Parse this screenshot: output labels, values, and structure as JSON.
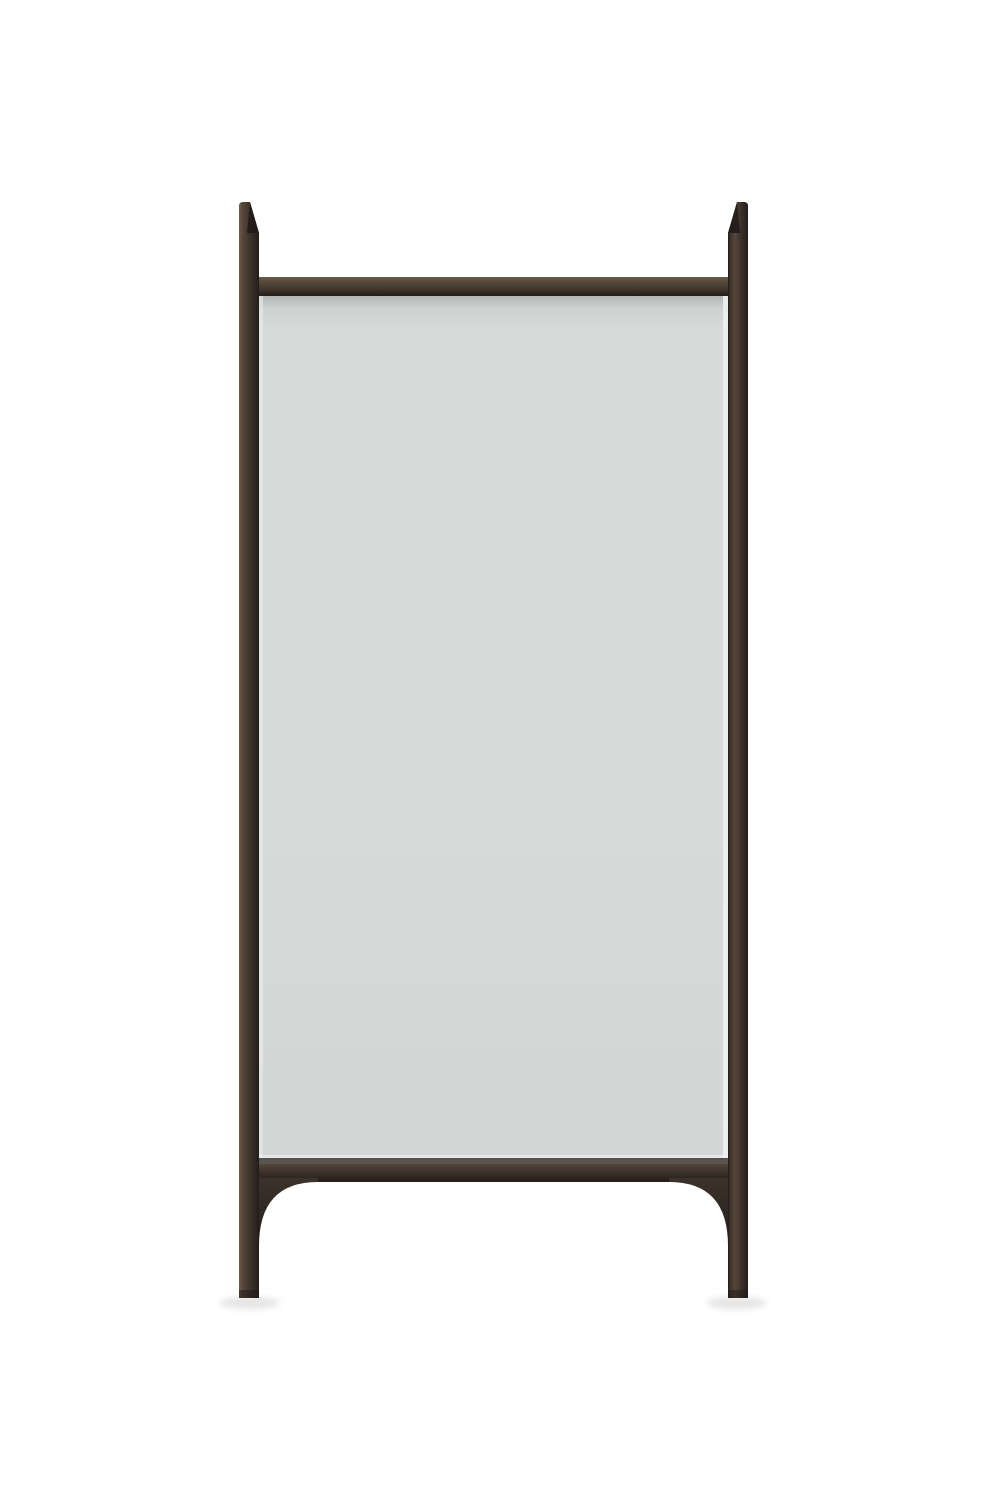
{
  "meta": {
    "subject": "floor-mirror"
  },
  "colors": {
    "background": "#ffffff",
    "glass": "#d8dad9",
    "glass_top": "#c6cbc9",
    "glass_bottom": "#d2d5d4",
    "glass_shade": "#9aa09d",
    "glass_edge_light": "#eef0ef",
    "glass_bottom_line": "#46423d",
    "wood_highlight": "#6e5a49",
    "wood_light": "#55463a",
    "wood_mid": "#3c322b",
    "wood_dark": "#2c2521",
    "wood_edge": "#221d19",
    "wood_facet": "#1f1a17",
    "shadow": "#4a453f"
  }
}
